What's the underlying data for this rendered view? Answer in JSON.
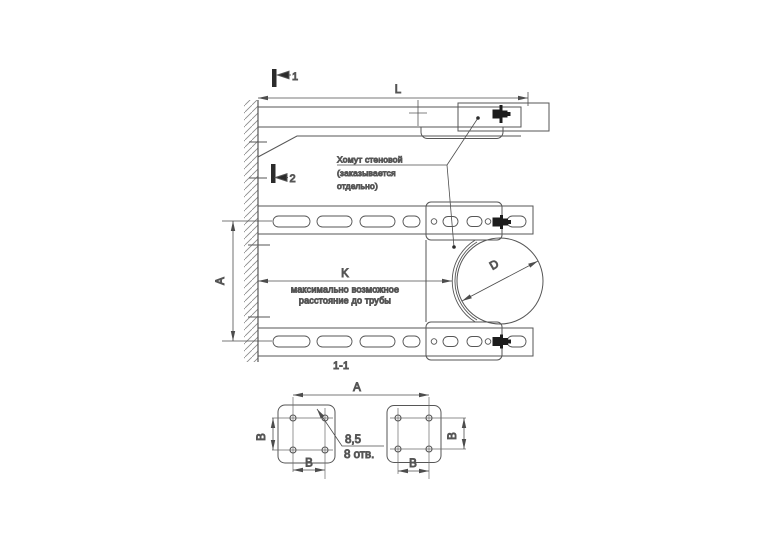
{
  "colors": {
    "line": "#565656",
    "dim": "#4d4d4d",
    "text": "#414141",
    "bolt": "#1c1c1c",
    "hatch": "#8a8a8a",
    "background": "#ffffff"
  },
  "side_view": {
    "section_marker_1": "1",
    "section_marker_2": "2",
    "dim_length": "L",
    "callout": {
      "line1": "Хомут стеновой",
      "line2": "(заказывается",
      "line3": "отдельно)"
    }
  },
  "section_view": {
    "label": "1-1",
    "dim_distance": "K",
    "note_line1": "максимально возможное",
    "note_line2": "расстояние до трубы",
    "dim_height": "A",
    "dim_diameter": "D"
  },
  "bottom_view": {
    "dim_width": "A",
    "dim_b": "B",
    "holes_diameter": "8,5",
    "holes_count": "8 отв."
  }
}
